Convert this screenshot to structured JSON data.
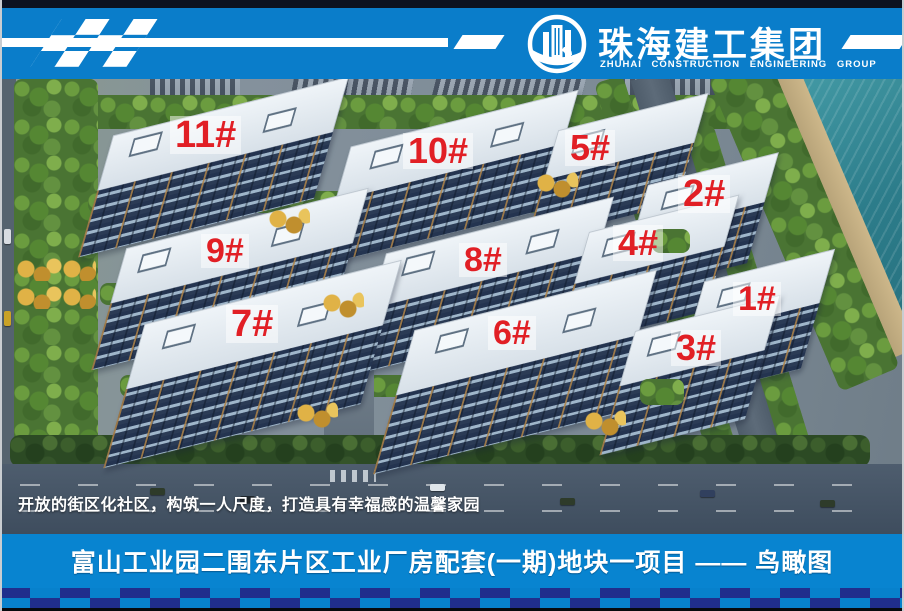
{
  "header": {
    "company_name_zh": "珠海建工集团",
    "company_name_en": "ZHUHAI CONSTRUCTION ENGINEERING GROUP",
    "logo_icon": "building-emblem-icon",
    "flag_icon": "checkered-flag-pattern"
  },
  "scene": {
    "caption": "开放的街区化社区，构筑一人尺度，打造具有幸福感的温馨家园",
    "buildings": [
      {
        "label": "1#"
      },
      {
        "label": "2#"
      },
      {
        "label": "3#"
      },
      {
        "label": "4#"
      },
      {
        "label": "5#"
      },
      {
        "label": "6#"
      },
      {
        "label": "7#"
      },
      {
        "label": "8#"
      },
      {
        "label": "9#"
      },
      {
        "label": "10#"
      },
      {
        "label": "11#"
      }
    ]
  },
  "footer": {
    "title": "富山工业园二围东片区工业厂房配套(一期)地块一项目 —— 鸟瞰图"
  },
  "colors": {
    "header_blue": "#0a7dca",
    "footer_blue": "#0884d0",
    "checker_navy": "#202e8c",
    "label_red": "#e11f25",
    "water_teal": "#2f8694"
  }
}
